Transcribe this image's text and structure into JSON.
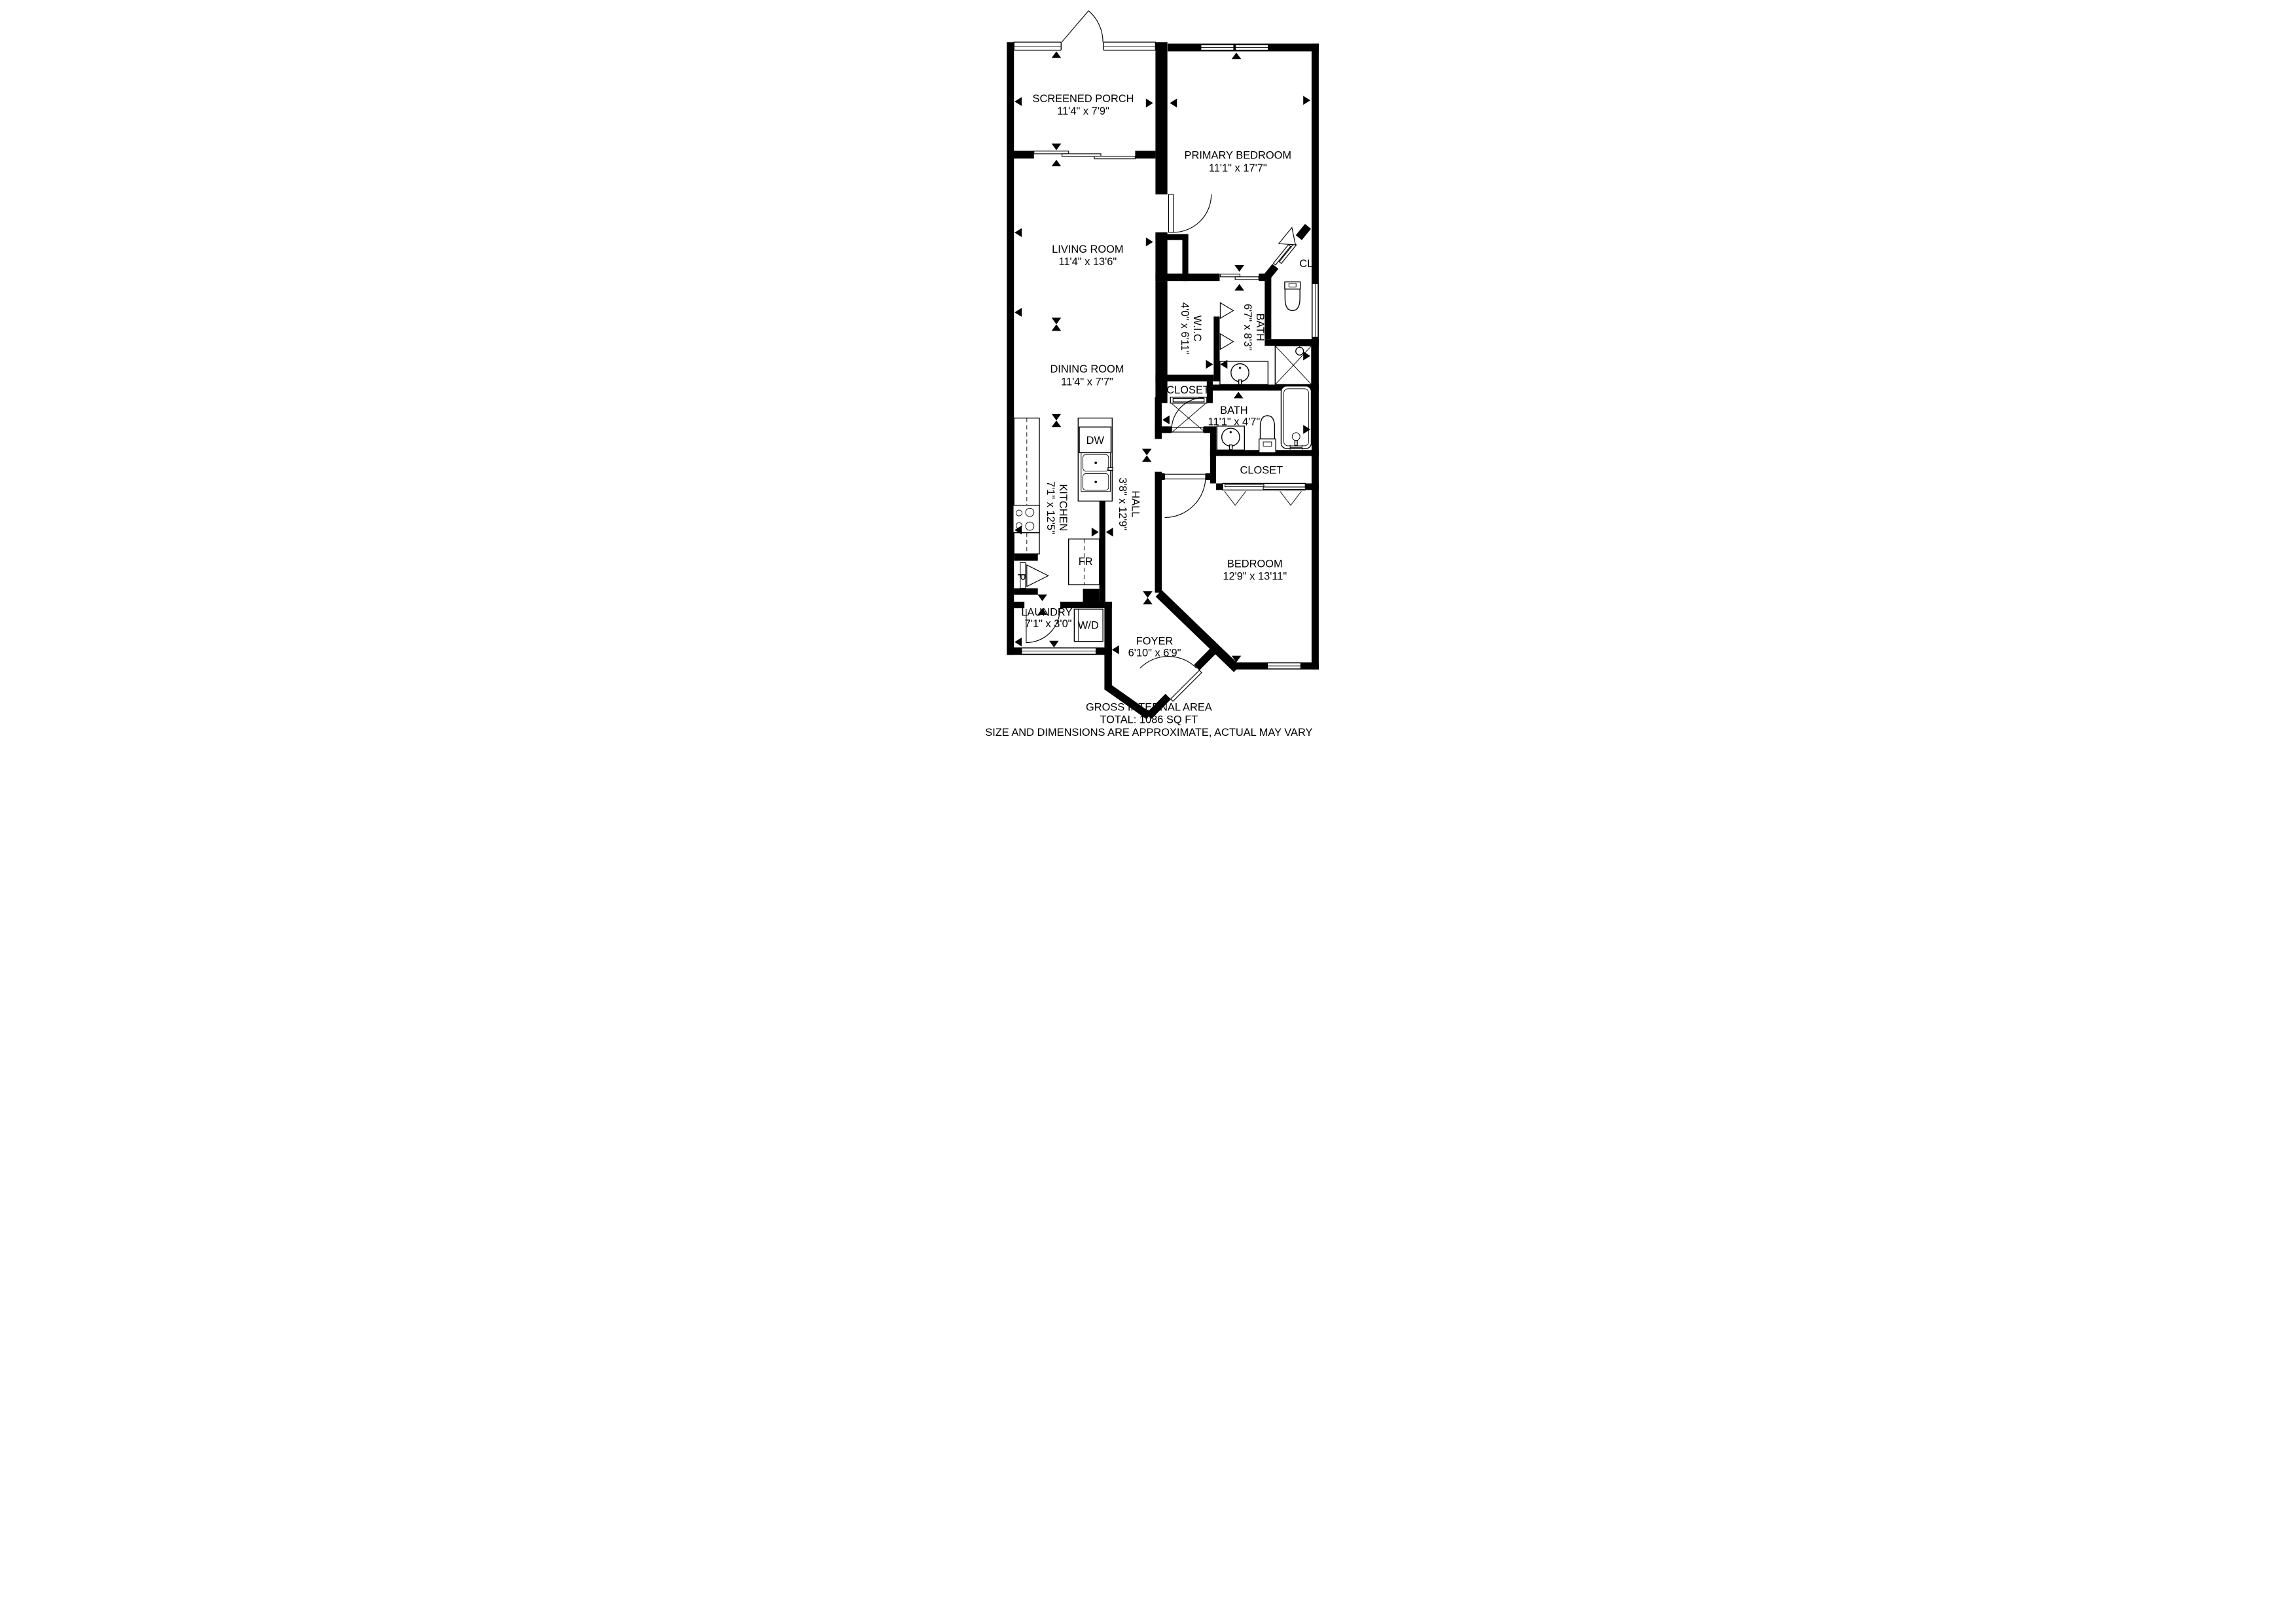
{
  "rooms": [
    {
      "name": "SCREENED PORCH",
      "dims": "11'4\" x 7'9\""
    },
    {
      "name": "PRIMARY BEDROOM",
      "dims": "11'1\" x 17'7\""
    },
    {
      "name": "LIVING ROOM",
      "dims": "11'4\" x 13'6\""
    },
    {
      "name": "DINING ROOM",
      "dims": "11'4\" x 7'7\""
    },
    {
      "name": "W.I.C",
      "dims": "4'0\" x 6'11\""
    },
    {
      "name": "BATH",
      "dims": "6'7\" x 8'3\""
    },
    {
      "name": "BATH",
      "dims": "11'1\" x 4'7\""
    },
    {
      "name": "KITCHEN",
      "dims": "7'1\" x 12'5\""
    },
    {
      "name": "HALL",
      "dims": "3'8\" x 12'9\""
    },
    {
      "name": "BEDROOM",
      "dims": "12'9\" x 13'11\""
    },
    {
      "name": "LAUNDRY",
      "dims": "7'1\" x 3'0\""
    },
    {
      "name": "FOYER",
      "dims": "6'10\" x 6'9\""
    }
  ],
  "labels": {
    "cl": "CL",
    "closet_hall": "CLOSET",
    "closet_bedroom": "CLOSET",
    "dw": "DW",
    "fr": "FR",
    "wd": "W/D",
    "pantry": "P"
  },
  "footer": {
    "line1": "GROSS INTERNAL AREA",
    "line2": "TOTAL: 1086 SQ FT",
    "line3": "SIZE AND DIMENSIONS ARE APPROXIMATE, ACTUAL MAY VARY"
  },
  "colors": {
    "wall": "#000000",
    "background": "#ffffff",
    "disclaimer": "#7f7f7f"
  }
}
